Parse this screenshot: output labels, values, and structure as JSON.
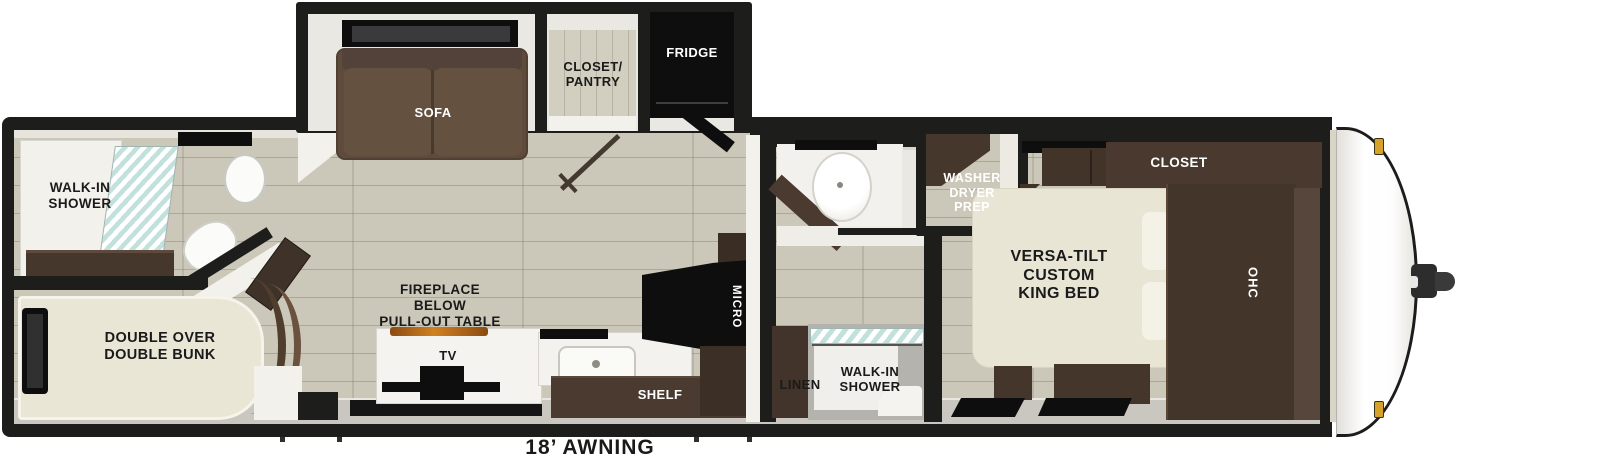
{
  "rear_bathroom": {
    "shower_label": "WALK-IN\nSHOWER"
  },
  "bunk_room": {
    "bunk_label": "DOUBLE OVER\nDOUBLE BUNK"
  },
  "living_area": {
    "sofa_label": "SOFA",
    "pantry_label": "CLOSET/\nPANTRY",
    "fridge_label": "FRIDGE",
    "fireplace_label": "FIREPLACE\nBELOW\nPULL-OUT TABLE",
    "tv_label": "TV",
    "shelf_label": "SHELF",
    "micro_label": "MICRO"
  },
  "mid_bathroom": {
    "linen_label": "LINEN",
    "shower_label": "WALK-IN\nSHOWER",
    "washer_label": "WASHER\nDRYER\nPREP"
  },
  "bedroom": {
    "bed_label": "VERSA-TILT\nCUSTOM\nKING BED",
    "closet_label": "CLOSET",
    "ohc_label": "OHC"
  },
  "exterior": {
    "awning_label": "18’ AWNING"
  },
  "colors": {
    "wall": "#1d1d1b",
    "floor": "#cbc7b9",
    "cabinet_dark": "#46372c",
    "sofa_brown": "#5e4b3c",
    "mattress_cream": "#eae6d5",
    "appliance_black": "#0e0e0e",
    "shower_glass": "#c2e1dc",
    "fireplace_glow": "#c1761d",
    "marker_light": "#d7a22a",
    "label_dark": "#1a1a1a",
    "label_light": "#ffffff"
  }
}
